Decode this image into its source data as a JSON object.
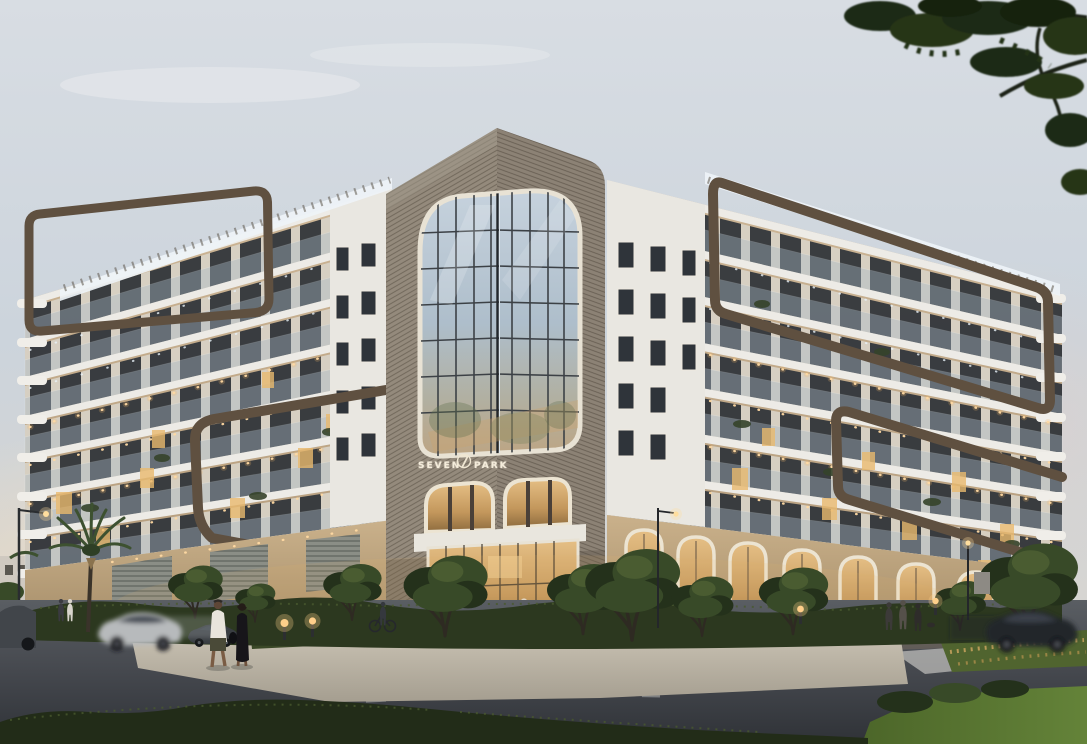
{
  "image": {
    "kind": "architectural exterior rendering",
    "setting": "street corner residential building at dusk"
  },
  "building": {
    "name": "Seven Park",
    "logo": {
      "word1": "SEVEN",
      "word2": "PARK",
      "emblem": "stylized numeral-7 monogram"
    },
    "storeys_visible": 8,
    "features": [
      "bronze rounded ribbon frames",
      "rooftop pergolas",
      "curved glass balcony railings",
      "arched corner glass curtain wall",
      "arched ground-floor arcade with warm lighting"
    ]
  },
  "scene": {
    "sky": "pale dusk sky with warm glow at left horizon",
    "vehicles": {
      "count": 4,
      "types": [
        "silver sedan in motion",
        "dark sedan parked",
        "dark suv at left edge",
        "dark car in motion at right"
      ]
    },
    "pedestrians": {
      "count": 9,
      "notable": [
        "man in white shirt",
        "woman in black dress",
        "cyclist",
        "group near right entrance"
      ]
    },
    "landscape": [
      "palm tree",
      "street trees",
      "hedges",
      "ornamental grasses",
      "lawn"
    ],
    "street": [
      "crosswalk",
      "lane dashes",
      "bollard path lights",
      "street lamps",
      "sidewalk plaza"
    ]
  },
  "palette": {
    "sky_top": "#d8dde3",
    "sky_mid": "#ccd4dc",
    "sky_warm": "#ead9c2",
    "facade_white": "#e9e7e1",
    "facade_warm": "#c7ae8d",
    "slab_white": "#edebe6",
    "window_dark": "#2f343a",
    "window_pier": "#d8d2c6",
    "railing_glass": "#a9bac8",
    "wood": "#93897b",
    "wood_dark": "#6e6558",
    "bronze": "#5f5040",
    "bronze_light": "#7d6a55",
    "glass_blue": "#b4c2d0",
    "arch_cream": "#ece4d2",
    "retail_wall": "#c3aa85",
    "warm_glow": "#e8b96e",
    "road": "#44484e",
    "road_dark": "#33363b",
    "plaza": "#bdb6aa",
    "hedge": "#2c381f",
    "hedge_light": "#49592e",
    "lawn": "#5e7a33",
    "tree_dark": "#24311b",
    "tree_mid": "#384a28",
    "canopy_overhang": "#1d2916",
    "trunk": "#2e2a22",
    "car_silver": "#b7babc",
    "car_dark": "#23262b",
    "white_light": "#eef3f7"
  }
}
